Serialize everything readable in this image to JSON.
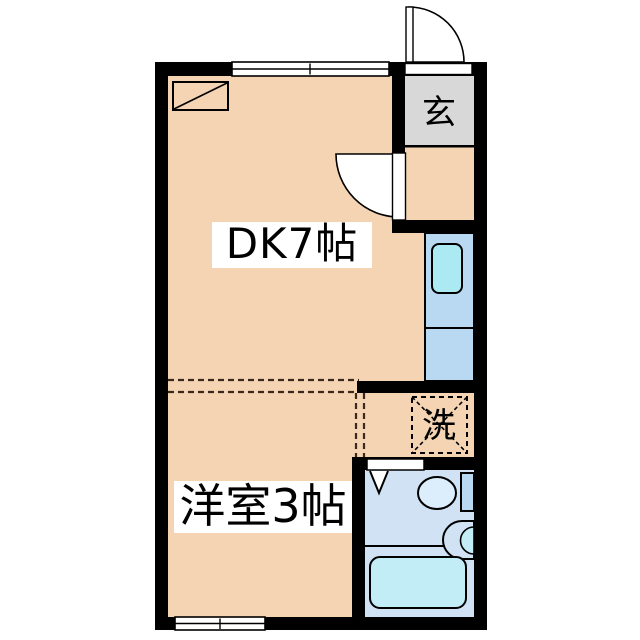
{
  "plan": {
    "title": "1DK apartment floor plan",
    "rooms": {
      "dk": {
        "label": "DK7帖"
      },
      "western_room": {
        "label": "洋室3帖"
      },
      "entrance": {
        "label": "玄"
      },
      "laundry": {
        "label": "洗"
      }
    },
    "colors": {
      "floor": "#f4d4b2",
      "entrance_floor": "#d8d8d8",
      "counter": "#b9d8f1",
      "kitchen_sink": "#abe9f3",
      "bathroom_floor": "#d0e2f4",
      "bathtub": "#c2ecf6",
      "toilet_bowl": "#dcedfb",
      "toilet_tank": "#b9d8f1",
      "wall": "#000000",
      "label_bg": "#ffffff"
    }
  }
}
